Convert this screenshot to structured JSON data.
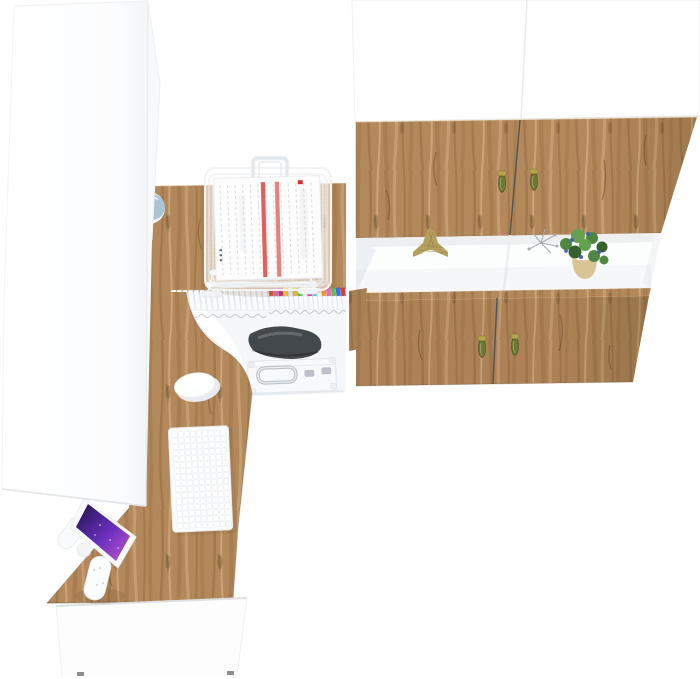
{
  "scene": {
    "description": "Top-down 3D render of a white and craft-oak home office furniture set: tall white wardrobe, L-shaped oak desk with monitor, keyboard, mouse and wire document tray, under-desk storage with file boxes, bag and briefcase, and a two-column wall cabinet with oak doors and an open display shelf.",
    "background": "#ffffff"
  },
  "palette": {
    "wood_base": "#b3885a",
    "wood_edge_dark": "rgba(96,60,24,0.35)",
    "white_panel": "#fdfdfe",
    "panel_edge": "#e7eaec",
    "seam_dark": "#4e545a",
    "handle_olive": "#6b7a2e",
    "handle_brass": "#b5a44c",
    "globe_blue": "#a9c6d6",
    "screen_navy": "#1d1446",
    "screen_violet": "#6a2fbf",
    "screen_magenta": "#c257c9",
    "bag_gray": "#43484d",
    "chrome": "#bcc2c8",
    "paper_red": "#e05048",
    "eiffel_gold": "#b3a05e",
    "eiffel_gold_dark": "#8f7c3c",
    "silver_decor": "#a6abb0",
    "plant_green": "#4f8742",
    "plant_green_dark": "#35622c",
    "plant_green_light": "#63a150",
    "plant_berry": "#4a5fa8",
    "pot_tan": "#d9c495",
    "pot_tan_dark": "#c2a872",
    "foot_dark": "#898e93"
  },
  "storage": {
    "plain_spine_count": 17,
    "file_label_colors": [
      "#e05a35",
      "#e86ab4",
      "#c9338f",
      "#f0d23e",
      "#f5f6f6",
      "#e8c93a",
      "#6cc04a",
      "#f5f6f6",
      "#d13ba0",
      "#4ec3e0",
      "#f2f3f3",
      "#f09a2e",
      "#e86ab4",
      "#5bbf4e",
      "#3f6fd8",
      "#d93a3a"
    ]
  },
  "keyboard": {
    "rows": 16,
    "cols": 9
  },
  "cabinet": {
    "columns": 2,
    "upper_door_handles": 2,
    "lower_door_handles": 2,
    "shelf_items": [
      "eiffel-tower-figurine",
      "silver-twig-decor",
      "potted-plant"
    ]
  }
}
